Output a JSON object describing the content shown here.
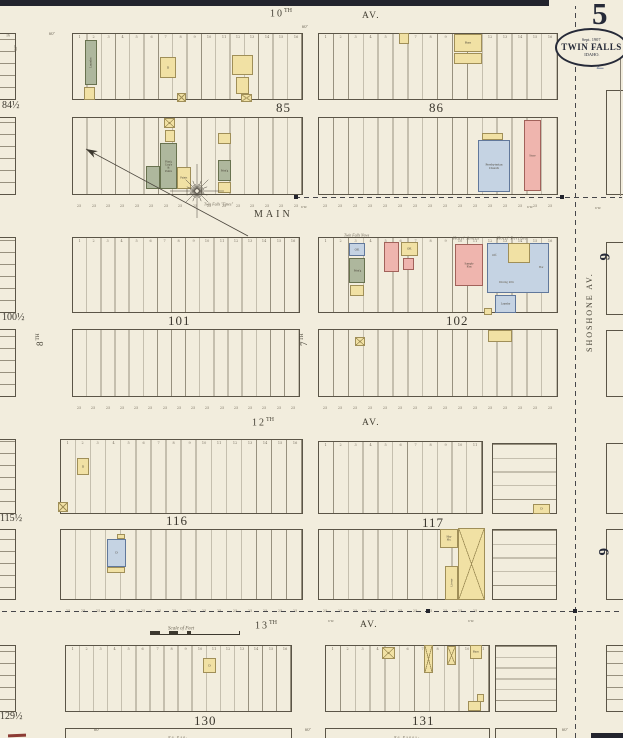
{
  "title_block": {
    "page_number": "5",
    "stamp_date": "Sept. 1907",
    "stamp_city": "TWIN FALLS",
    "stamp_state": "IDAHO.",
    "secondary_number": "2"
  },
  "colors": {
    "paper": "#f2eddd",
    "border_band": "#23242d",
    "ink": "#5b5547",
    "lot_line": "#98917f",
    "tiny_text": "#6b6455",
    "number_text": "#7a7263",
    "label_text": "#4a4438",
    "navy": "#262a38",
    "ghost_number": "#9aa1ae",
    "red_mark": "#8c3b34",
    "wood_yellow": "#f1e1a4",
    "wood_border": "#a08f58",
    "brick_pink": "#efb5ae",
    "brick_border": "#a2625a",
    "stone_blue": "#c5d3e3",
    "stone_border": "#61789b",
    "special_olive": "#aeb79d",
    "special_border": "#68724f"
  },
  "streets": [
    {
      "t": "10",
      "sup": "TH",
      "x": 270,
      "y": 8,
      "s": 10,
      "ls": 2
    },
    {
      "t": "AV.",
      "x": 362,
      "y": 11,
      "s": 9.5,
      "ls": 1.5
    },
    {
      "t": "MAIN",
      "x": 254,
      "y": 209,
      "s": 10,
      "ls": 3
    },
    {
      "t": "12",
      "sup": "TH",
      "x": 252,
      "y": 417,
      "s": 10,
      "ls": 2
    },
    {
      "t": "AV.",
      "x": 362,
      "y": 418,
      "s": 9.5,
      "ls": 1.5
    },
    {
      "t": "13",
      "sup": "TH",
      "x": 255,
      "y": 620,
      "s": 10,
      "ls": 2
    },
    {
      "t": "AV.",
      "x": 360,
      "y": 620,
      "s": 9.5,
      "ls": 1.5
    },
    {
      "t": "7",
      "sup": "TH",
      "x": 299,
      "y": 346,
      "s": 9,
      "rot": -90
    },
    {
      "t": "8",
      "sup": "TH",
      "x": 35,
      "y": 346,
      "s": 9,
      "rot": -90
    },
    {
      "t": "SHOSHONE AV.",
      "x": 585,
      "y": 352,
      "s": 8,
      "ls": 2,
      "rot": -90
    }
  ],
  "block_numbers": [
    {
      "t": "85",
      "x": 276,
      "y": 100
    },
    {
      "t": "86",
      "x": 429,
      "y": 100
    },
    {
      "t": "101",
      "x": 168,
      "y": 313
    },
    {
      "t": "102",
      "x": 446,
      "y": 313
    },
    {
      "t": "116",
      "x": 166,
      "y": 513
    },
    {
      "t": "117",
      "x": 422,
      "y": 515
    },
    {
      "t": "130",
      "x": 194,
      "y": 713
    },
    {
      "t": "131",
      "x": 412,
      "y": 713
    }
  ],
  "edge_block_numbers": [
    {
      "t": "84½",
      "x": 2,
      "y": 100
    },
    {
      "t": "100½",
      "x": 2,
      "y": 312
    },
    {
      "t": "115½",
      "x": 0,
      "y": 513
    },
    {
      "t": "129½",
      "x": 0,
      "y": 711
    }
  ],
  "district_numbers": [
    {
      "t": "6",
      "x": 612,
      "y": 253
    },
    {
      "t": "6",
      "x": 611,
      "y": 548
    }
  ],
  "tiers": [
    {
      "x": 72,
      "y": 33,
      "w": 231,
      "h": 67,
      "lots": 16,
      "nums": "top"
    },
    {
      "x": 72,
      "y": 117,
      "w": 231,
      "h": 78,
      "lots": 16,
      "nums": "bottom"
    },
    {
      "x": 318,
      "y": 33,
      "w": 240,
      "h": 67,
      "lots": 16,
      "nums": "top"
    },
    {
      "x": 318,
      "y": 117,
      "w": 240,
      "h": 78,
      "lots": 16,
      "nums": "bottom"
    },
    {
      "x": 72,
      "y": 237,
      "w": 228,
      "h": 76,
      "lots": 16,
      "nums": "top"
    },
    {
      "x": 72,
      "y": 329,
      "w": 228,
      "h": 68,
      "lots": 16,
      "nums": "bottom"
    },
    {
      "x": 318,
      "y": 237,
      "w": 240,
      "h": 76,
      "lots": 16,
      "nums": "top"
    },
    {
      "x": 318,
      "y": 329,
      "w": 240,
      "h": 68,
      "lots": 16,
      "nums": "bottom"
    },
    {
      "x": 60,
      "y": 439,
      "w": 243,
      "h": 75,
      "lots": 16,
      "nums": "top"
    },
    {
      "x": 60,
      "y": 529,
      "w": 243,
      "h": 71,
      "lots": 16,
      "nums": "bottom"
    },
    {
      "x": 318,
      "y": 441,
      "w": 165,
      "h": 73,
      "lots": 11,
      "nums": "top"
    },
    {
      "x": 318,
      "y": 529,
      "w": 165,
      "h": 71,
      "lots": 11,
      "nums": "bottom"
    },
    {
      "x": 65,
      "y": 645,
      "w": 227,
      "h": 67,
      "lots": 16,
      "nums": "top"
    },
    {
      "x": 325,
      "y": 645,
      "w": 165,
      "h": 67,
      "lots": 11,
      "nums": "top"
    }
  ],
  "sub_tiers": [
    {
      "x": 492,
      "y": 443,
      "w": 65,
      "h": 71,
      "rows": 5
    },
    {
      "x": 492,
      "y": 529,
      "w": 65,
      "h": 71,
      "rows": 5
    },
    {
      "x": 495,
      "y": 645,
      "w": 62,
      "h": 67,
      "rows": 6
    }
  ],
  "slivers": [
    {
      "x": -8,
      "y": 33,
      "w": 24,
      "h": 67,
      "lines": true
    },
    {
      "x": -8,
      "y": 117,
      "w": 24,
      "h": 78,
      "lines": true
    },
    {
      "x": -8,
      "y": 237,
      "w": 24,
      "h": 76,
      "lines": true
    },
    {
      "x": -8,
      "y": 329,
      "w": 24,
      "h": 68,
      "lines": true
    },
    {
      "x": -8,
      "y": 439,
      "w": 24,
      "h": 75,
      "lines": true
    },
    {
      "x": -8,
      "y": 529,
      "w": 24,
      "h": 71,
      "lines": true
    },
    {
      "x": -8,
      "y": 645,
      "w": 24,
      "h": 67,
      "lines": true
    },
    {
      "x": 606,
      "y": 90,
      "w": 26,
      "h": 105,
      "lines": false
    },
    {
      "x": 606,
      "y": 242,
      "w": 26,
      "h": 73,
      "lines": false
    },
    {
      "x": 606,
      "y": 330,
      "w": 26,
      "h": 67,
      "lines": false
    },
    {
      "x": 606,
      "y": 443,
      "w": 26,
      "h": 71,
      "lines": false
    },
    {
      "x": 606,
      "y": 529,
      "w": 26,
      "h": 71,
      "lines": false
    },
    {
      "x": 606,
      "y": 645,
      "w": 26,
      "h": 67,
      "lines": true
    }
  ],
  "strips": [
    {
      "x": 65,
      "y": 728,
      "w": 227,
      "h": 12,
      "l": "No Exp."
    },
    {
      "x": 325,
      "y": 728,
      "w": 165,
      "h": 12,
      "l": "No Expos-"
    },
    {
      "x": 495,
      "y": 728,
      "w": 62,
      "h": 12,
      "l": ""
    }
  ],
  "buildings": [
    {
      "x": 85,
      "y": 40,
      "w": 12,
      "h": 45,
      "c": "o",
      "l": "Laundry",
      "rot": true
    },
    {
      "x": 84,
      "y": 87,
      "w": 11,
      "h": 13,
      "c": "y"
    },
    {
      "x": 160,
      "y": 57,
      "w": 16,
      "h": 21,
      "c": "y",
      "l": "D"
    },
    {
      "x": 232,
      "y": 55,
      "w": 21,
      "h": 20,
      "c": "y"
    },
    {
      "x": 236,
      "y": 77,
      "w": 13,
      "h": 17,
      "c": "y"
    },
    {
      "x": 241,
      "y": 94,
      "w": 11,
      "h": 8,
      "c": "y",
      "xm": true
    },
    {
      "x": 177,
      "y": 93,
      "w": 9,
      "h": 9,
      "c": "y",
      "xm": true
    },
    {
      "x": 164,
      "y": 118,
      "w": 11,
      "h": 10,
      "c": "y",
      "xm": true
    },
    {
      "x": 165,
      "y": 130,
      "w": 10,
      "h": 12,
      "c": "y"
    },
    {
      "x": 160,
      "y": 143,
      "w": 17,
      "h": 46,
      "c": "o",
      "l": "Plan'g Carp'y & Paints",
      "s": 2.8
    },
    {
      "x": 146,
      "y": 166,
      "w": 14,
      "h": 23,
      "c": "o"
    },
    {
      "x": 177,
      "y": 167,
      "w": 14,
      "h": 22,
      "c": "y",
      "l": "Paints",
      "s": 2.8
    },
    {
      "x": 218,
      "y": 133,
      "w": 13,
      "h": 11,
      "c": "y"
    },
    {
      "x": 218,
      "y": 160,
      "w": 13,
      "h": 21,
      "c": "o",
      "l": "Print'g",
      "s": 2.8
    },
    {
      "x": 218,
      "y": 182,
      "w": 13,
      "h": 11,
      "c": "y"
    },
    {
      "x": 399,
      "y": 33,
      "w": 10,
      "h": 11,
      "c": "y"
    },
    {
      "x": 454,
      "y": 34,
      "w": 28,
      "h": 18,
      "c": "y",
      "l": "Barn"
    },
    {
      "x": 454,
      "y": 53,
      "w": 28,
      "h": 11,
      "c": "y"
    },
    {
      "x": 482,
      "y": 133,
      "w": 21,
      "h": 7,
      "c": "y"
    },
    {
      "x": 478,
      "y": 140,
      "w": 32,
      "h": 52,
      "c": "b",
      "l": "Presbyterian Church",
      "s": 3.4
    },
    {
      "x": 524,
      "y": 120,
      "w": 17,
      "h": 71,
      "c": "p",
      "l": "Store",
      "s": 3
    },
    {
      "x": 349,
      "y": 243,
      "w": 16,
      "h": 13,
      "c": "b",
      "l": "Off.",
      "s": 3
    },
    {
      "x": 349,
      "y": 258,
      "w": 16,
      "h": 25,
      "c": "o",
      "l": "Print'g",
      "s": 2.8
    },
    {
      "x": 350,
      "y": 285,
      "w": 14,
      "h": 11,
      "c": "y"
    },
    {
      "x": 384,
      "y": 242,
      "w": 15,
      "h": 30,
      "c": "p"
    },
    {
      "x": 401,
      "y": 242,
      "w": 17,
      "h": 14,
      "c": "y",
      "l": "Off.",
      "s": 3
    },
    {
      "x": 403,
      "y": 258,
      "w": 11,
      "h": 12,
      "c": "p"
    },
    {
      "x": 455,
      "y": 244,
      "w": 28,
      "h": 42,
      "c": "p",
      "l": "Sample R'm",
      "s": 3
    },
    {
      "x": 487,
      "y": 243,
      "w": 62,
      "h": 50,
      "c": "b"
    },
    {
      "x": 508,
      "y": 243,
      "w": 22,
      "h": 20,
      "c": "y"
    },
    {
      "x": 495,
      "y": 295,
      "w": 21,
      "h": 18,
      "c": "b",
      "l": "Laundry",
      "s": 2.8
    },
    {
      "x": 484,
      "y": 308,
      "w": 8,
      "h": 7,
      "c": "y"
    },
    {
      "x": 355,
      "y": 337,
      "w": 10,
      "h": 9,
      "c": "y",
      "xm": true
    },
    {
      "x": 488,
      "y": 330,
      "w": 24,
      "h": 12,
      "c": "y"
    },
    {
      "x": 77,
      "y": 458,
      "w": 12,
      "h": 17,
      "c": "y",
      "l": "D"
    },
    {
      "x": 58,
      "y": 502,
      "w": 10,
      "h": 10,
      "c": "y",
      "xm": true
    },
    {
      "x": 117,
      "y": 534,
      "w": 8,
      "h": 5,
      "c": "y"
    },
    {
      "x": 107,
      "y": 539,
      "w": 19,
      "h": 28,
      "c": "b",
      "l": "D"
    },
    {
      "x": 107,
      "y": 567,
      "w": 18,
      "h": 6,
      "c": "y"
    },
    {
      "x": 533,
      "y": 504,
      "w": 17,
      "h": 10,
      "c": "y",
      "l": "D"
    },
    {
      "x": 440,
      "y": 529,
      "w": 18,
      "h": 19,
      "c": "y",
      "l": "Hay Ho.",
      "s": 3
    },
    {
      "x": 458,
      "y": 528,
      "w": 27,
      "h": 72,
      "c": "y",
      "xm": true
    },
    {
      "x": 445,
      "y": 566,
      "w": 13,
      "h": 34,
      "c": "y",
      "l": "Livery",
      "rot": true,
      "s": 3
    },
    {
      "x": 203,
      "y": 658,
      "w": 13,
      "h": 15,
      "c": "y",
      "l": "D"
    },
    {
      "x": 382,
      "y": 647,
      "w": 13,
      "h": 12,
      "c": "y",
      "xm": true
    },
    {
      "x": 424,
      "y": 645,
      "w": 9,
      "h": 28,
      "c": "y",
      "xm": true
    },
    {
      "x": 447,
      "y": 646,
      "w": 9,
      "h": 19,
      "c": "y",
      "xm": true
    },
    {
      "x": 470,
      "y": 645,
      "w": 12,
      "h": 14,
      "c": "y",
      "l": "Barn",
      "s": 3
    },
    {
      "x": 468,
      "y": 701,
      "w": 13,
      "h": 10,
      "c": "y"
    },
    {
      "x": 477,
      "y": 694,
      "w": 7,
      "h": 8,
      "c": "y"
    }
  ],
  "small_texts": [
    {
      "t": "Hotel Annex",
      "x": 453,
      "y": 230,
      "s": 4.2,
      "i": true,
      "ls": 1
    },
    {
      "t": "Hotel Perrine",
      "x": 497,
      "y": 230,
      "s": 4.2,
      "i": true,
      "ls": 1
    },
    {
      "t": "Twin Falls News",
      "x": 344,
      "y": 227,
      "s": 3.8,
      "i": true
    },
    {
      "t": "Twin Falls \"Times\"",
      "x": 204,
      "y": 196,
      "s": 3.8,
      "i": true
    },
    {
      "t": "Off.",
      "x": 492,
      "y": 247,
      "s": 3.2
    },
    {
      "t": "Dining R'm",
      "x": 499,
      "y": 274,
      "s": 3.2
    },
    {
      "t": "Bar",
      "x": 539,
      "y": 259,
      "s": 3.2
    },
    {
      "t": "60'",
      "x": 49,
      "y": 25,
      "s": 4.5,
      "i": true
    },
    {
      "t": "60'",
      "x": 302,
      "y": 18,
      "s": 4.5,
      "i": true
    },
    {
      "t": "50'",
      "x": 13,
      "y": 45,
      "s": 4.5,
      "i": true,
      "rot": -90
    },
    {
      "t": "60'",
      "x": 94,
      "y": 721,
      "s": 4.5,
      "i": true
    },
    {
      "t": "60'",
      "x": 305,
      "y": 721,
      "s": 4.5,
      "i": true
    },
    {
      "t": "60'",
      "x": 562,
      "y": 721,
      "s": 4.5,
      "i": true
    },
    {
      "t": "6'W.",
      "x": 301,
      "y": 199,
      "s": 3.5,
      "i": true
    },
    {
      "t": "6'W.",
      "x": 527,
      "y": 199,
      "s": 3.5,
      "i": true
    },
    {
      "t": "6'W.",
      "x": 595,
      "y": 200,
      "s": 3.5,
      "i": true
    },
    {
      "t": "6'W.",
      "x": 328,
      "y": 613,
      "s": 3.5,
      "i": true
    },
    {
      "t": "6'W.",
      "x": 468,
      "y": 613,
      "s": 3.5,
      "i": true
    },
    {
      "t": "16",
      "x": 6,
      "y": 27,
      "s": 4
    }
  ],
  "dashed_lines": [
    {
      "x": 575,
      "y": 6,
      "len": 732,
      "v": true
    },
    {
      "x": 295,
      "y": 197,
      "len": 327,
      "v": false
    },
    {
      "x": 2,
      "y": 611,
      "len": 620,
      "v": false
    }
  ],
  "solid_lines": [
    {
      "x": 620,
      "y": 58,
      "len": 138,
      "v": true
    }
  ],
  "dots": [
    [
      294,
      195
    ],
    [
      560,
      195
    ],
    [
      426,
      609
    ],
    [
      573,
      609
    ]
  ],
  "scale_bar": {
    "x": 150,
    "y": 631,
    "w": 88,
    "label": "Scale of Feet"
  },
  "compass": {
    "cx": 197,
    "cy": 191,
    "tip": [
      86,
      149
    ],
    "tail": [
      248,
      236
    ]
  }
}
